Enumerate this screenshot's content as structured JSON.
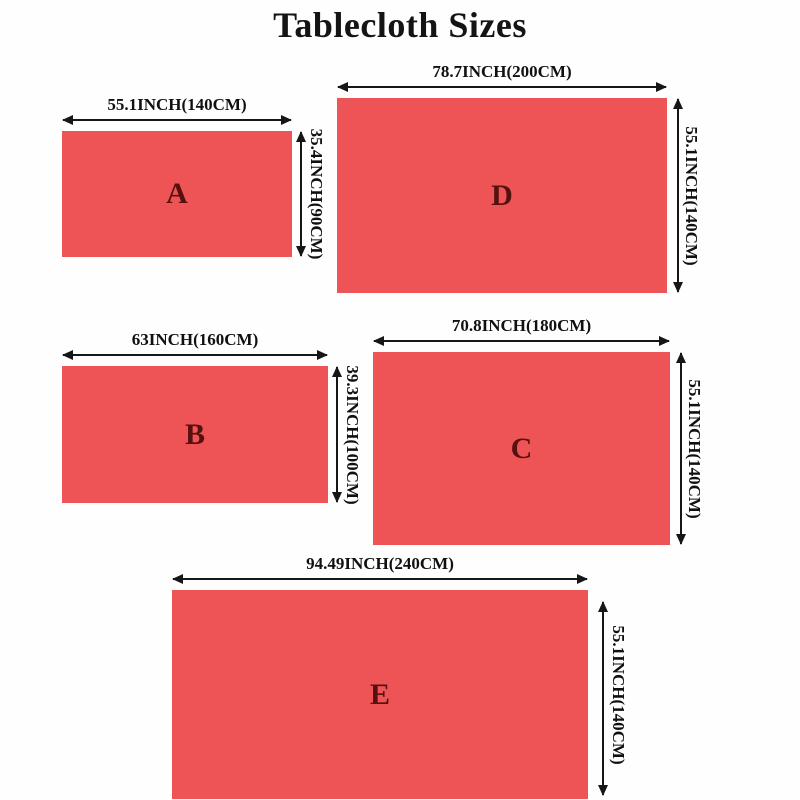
{
  "title": "Tablecloth Sizes",
  "colors": {
    "cloth": "#ee5456",
    "letter": "#551010",
    "arrow": "#161616",
    "label": "#101010",
    "title": "#141414",
    "background": "#fefefe"
  },
  "figures": [
    {
      "letter": "A",
      "width_label": "55.1INCH(140CM)",
      "height_label": "35.4INCH(90CM)"
    },
    {
      "letter": "D",
      "width_label": "78.7INCH(200CM)",
      "height_label": "55.1INCH(140CM)"
    },
    {
      "letter": "B",
      "width_label": "63INCH(160CM)",
      "height_label": "39.3INCH(100CM)"
    },
    {
      "letter": "C",
      "width_label": "70.8INCH(180CM)",
      "height_label": "55.1INCH(140CM)"
    },
    {
      "letter": "E",
      "width_label": "94.49INCH(240CM)",
      "height_label": "55.1INCH(140CM)"
    }
  ]
}
